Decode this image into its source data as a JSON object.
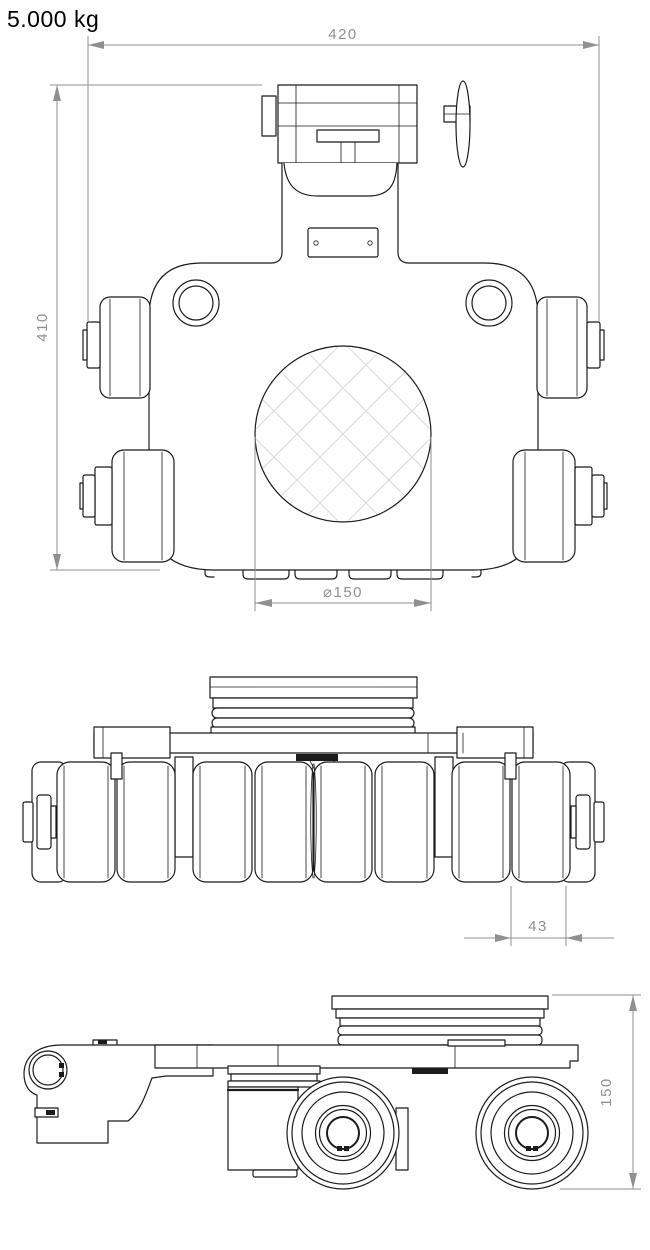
{
  "header": {
    "capacity_label": "5.000 kg"
  },
  "drawing": {
    "views": {
      "top": {
        "dimensions": {
          "overall_width": "420",
          "overall_length": "410",
          "center_plate_diameter": "⌀150"
        }
      },
      "front": {
        "dimensions": {
          "roller_width": "43"
        }
      },
      "side": {
        "dimensions": {
          "overall_height": "150"
        }
      }
    },
    "style": {
      "line_color": "#1b1b1b",
      "dimension_color": "#8e9092",
      "hatch_color": "#d9d9d9",
      "background": "#ffffff"
    }
  }
}
